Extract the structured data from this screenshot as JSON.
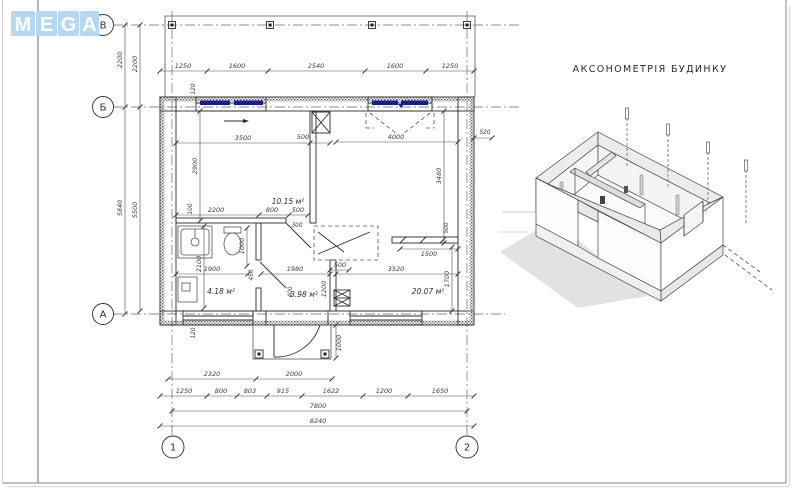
{
  "logo": {
    "letters": [
      "M",
      "E",
      "G",
      "A"
    ],
    "tile_color": "#b5d8f1"
  },
  "axon_title": "АКСОНОМЕТРІЯ БУДИНКУ",
  "grid": {
    "row_v": "В",
    "row_b": "Б",
    "row_a": "А",
    "col_1": "1",
    "col_2": "2"
  },
  "dims": {
    "top": [
      "1250",
      "1600",
      "2540",
      "1600",
      "1250"
    ],
    "left_outer_vb": "2200",
    "left_inner_vb": "2200",
    "left_outer_ba": "5840",
    "left_inner_ba": "5500",
    "offset_left_top": "120",
    "offset_left_bottom": "120",
    "offset_right": "520",
    "offset_100": "100",
    "bedroom_w": "3500",
    "bedroom_niche": "500",
    "bedroom_h": "2900",
    "bedroom_b1": "2200",
    "bedroom_b2": "800",
    "bedroom_b3": "500",
    "bath_w": "1900",
    "bath_h": "2100",
    "bath_wc": "1000",
    "bath_450": "450",
    "bath_400": "400",
    "door_300": "300",
    "hall_w": "1980",
    "hall_500": "500",
    "hall_1200": "1200",
    "living_w": "3520",
    "living_top": "4000",
    "living_h": "3480",
    "living_shelf": "1500",
    "living_1700": "1700",
    "living_500": "500",
    "porch_h": "1000",
    "porch_w": "2000",
    "b1": [
      "2320",
      "2000"
    ],
    "b2": [
      "1250",
      "800",
      "803",
      "915",
      "1622",
      "1200",
      "1650"
    ],
    "total_grid": "7800",
    "total_full": "8240"
  },
  "rooms": {
    "bedroom": "10.15 м²",
    "bath": "4.18 м²",
    "hall": "3.98 м²",
    "living": "20.07 м²"
  }
}
